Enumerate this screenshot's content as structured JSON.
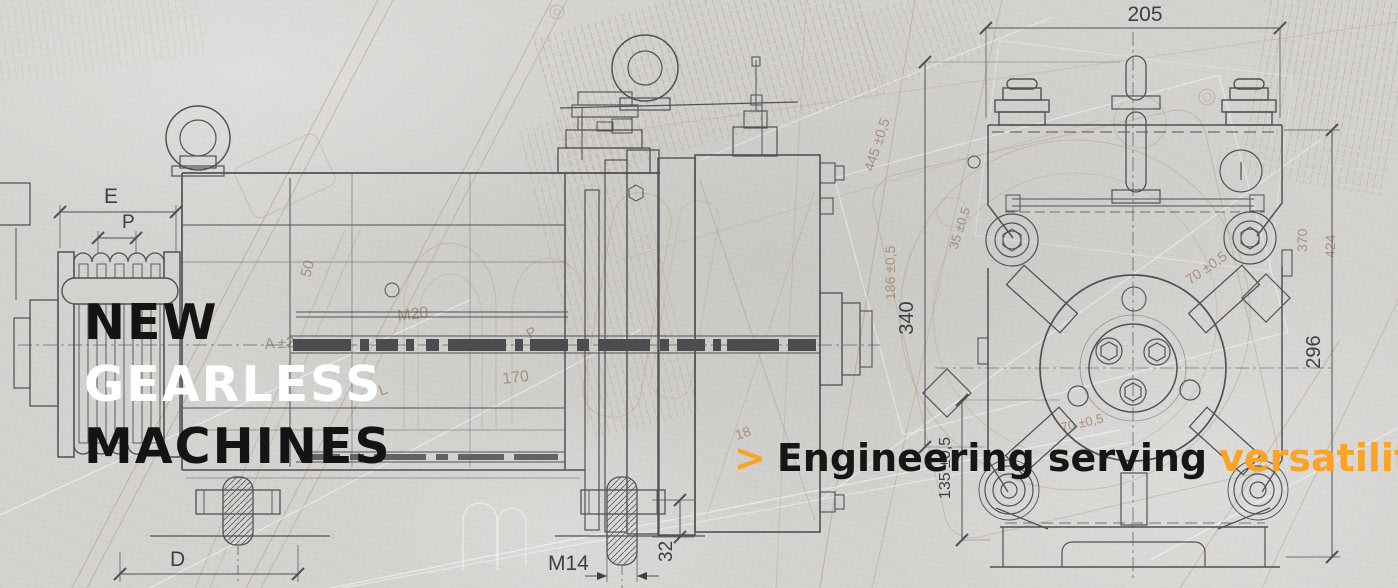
{
  "hero": {
    "headline": [
      "NEW",
      "GEARLESS",
      "MACHINES"
    ],
    "tagline": {
      "arrow": ">",
      "dark": "Engineering serving",
      "accent": "versatility"
    }
  },
  "colors": {
    "paper": "#D3D2CF",
    "ink_dark": "#141414",
    "ink_white": "#FFFFFF",
    "accent_orange": "#F9A426",
    "drawing_line": "#505156",
    "sketch_line": "#B39A82"
  },
  "dimensions": {
    "side_view": {
      "e": "E",
      "p": "P",
      "d": "D",
      "m14": "M14",
      "d32": "32"
    },
    "front_view": {
      "d205": "205",
      "d340": "340",
      "d135": "135 ±0,5",
      "d296": "296"
    },
    "sketch": {
      "d50": "50",
      "m20": "M20",
      "a2": "A ±2",
      "p": "P",
      "d170": "170",
      "l": "L",
      "d18": "18",
      "d445": "445 ±0,5",
      "d186": "186 ±0,5",
      "d35": "35 ±0,5",
      "d70a": "70 ±0,5",
      "d70b": "70 ±0,5",
      "d370": "370",
      "d424": "424"
    }
  }
}
